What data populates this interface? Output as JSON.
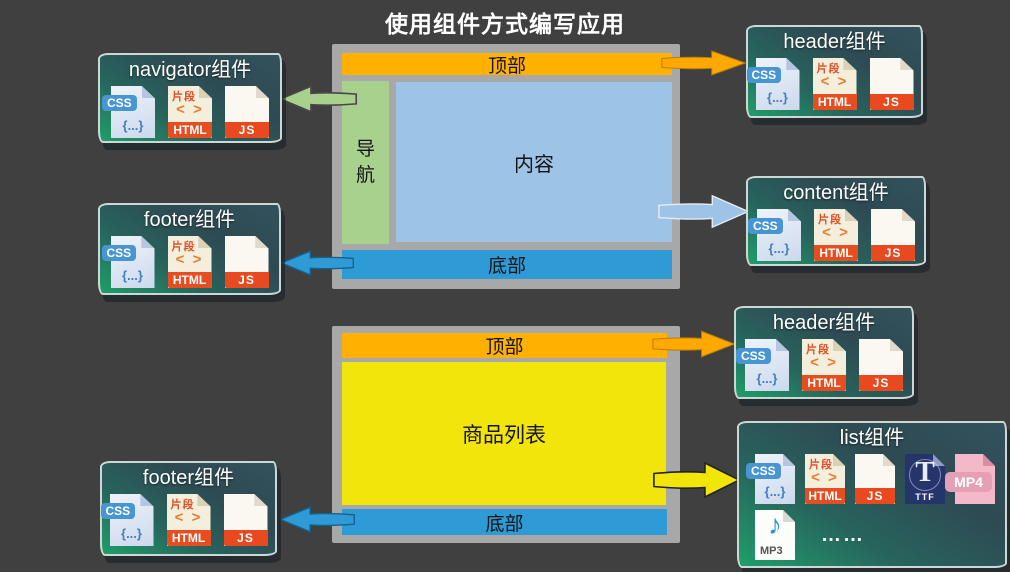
{
  "title": "使用组件方式编写应用",
  "layout1": {
    "top": "顶部",
    "nav": "导航",
    "content": "内容",
    "bottom": "底部"
  },
  "layout2": {
    "top": "顶部",
    "list": "商品列表",
    "bottom": "底部"
  },
  "cards": {
    "navigator": {
      "title": "navigator组件"
    },
    "header1": {
      "title": "header组件"
    },
    "footer1": {
      "title": "footer组件"
    },
    "content": {
      "title": "content组件"
    },
    "header2": {
      "title": "header组件"
    },
    "list": {
      "title": "list组件",
      "ellipsis": "……"
    },
    "footer2": {
      "title": "footer组件"
    }
  },
  "icons": {
    "css": {
      "label": "CSS",
      "symbol": "{...}"
    },
    "html": {
      "tag": "片段",
      "symbol": "< >",
      "label": "HTML"
    },
    "js": {
      "label": "JS"
    },
    "ttf": {
      "letter": "T",
      "label": "TTF"
    },
    "mp4": {
      "label": "MP4"
    },
    "mp3": {
      "note": "♪",
      "label": "MP3"
    }
  },
  "colors": {
    "background": "#404040",
    "frame_gray": "#a8a8a8",
    "top_bar_orange": "#ffb000",
    "nav_green": "#a9d18e",
    "content_blue": "#9dc3e6",
    "bottom_bar_blue": "#2e9bd6",
    "list_yellow": "#f2e50b",
    "card_green": "#1f9e6a",
    "card_slate": "#33525c"
  }
}
